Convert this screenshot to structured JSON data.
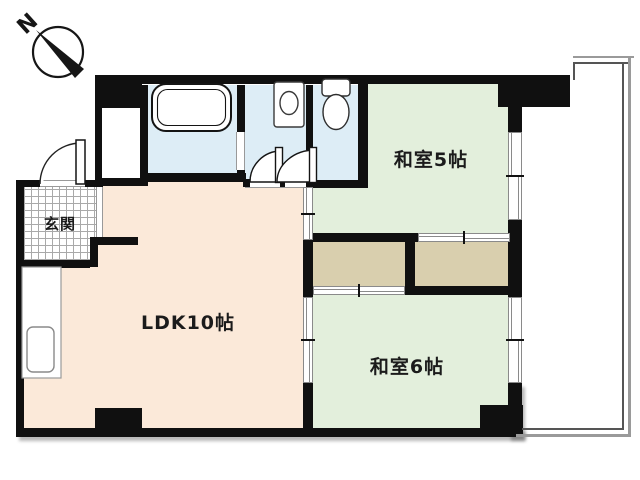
{
  "compass": {
    "label": "N"
  },
  "rooms": {
    "genkan": {
      "label": "玄関"
    },
    "ldk": {
      "label": "LDK10帖"
    },
    "washitsu5": {
      "label": "和室5帖"
    },
    "washitsu6": {
      "label": "和室6帖"
    }
  },
  "icons": {
    "compass": "north-arrow",
    "bathtub": "bathtub-outline",
    "washbasin": "sink-with-oval-basin",
    "toilet": "toilet-tank-and-bowl",
    "kitchen": "counter-with-sink"
  },
  "colors": {
    "wall": "#101010",
    "ldk_floor": "#fbe9d9",
    "washitsu_floor": "#e3efdc",
    "closet_floor": "#d9cfae",
    "wet_area_floor": "#ddedf6",
    "symbol_outline": "#8a8a8a"
  }
}
